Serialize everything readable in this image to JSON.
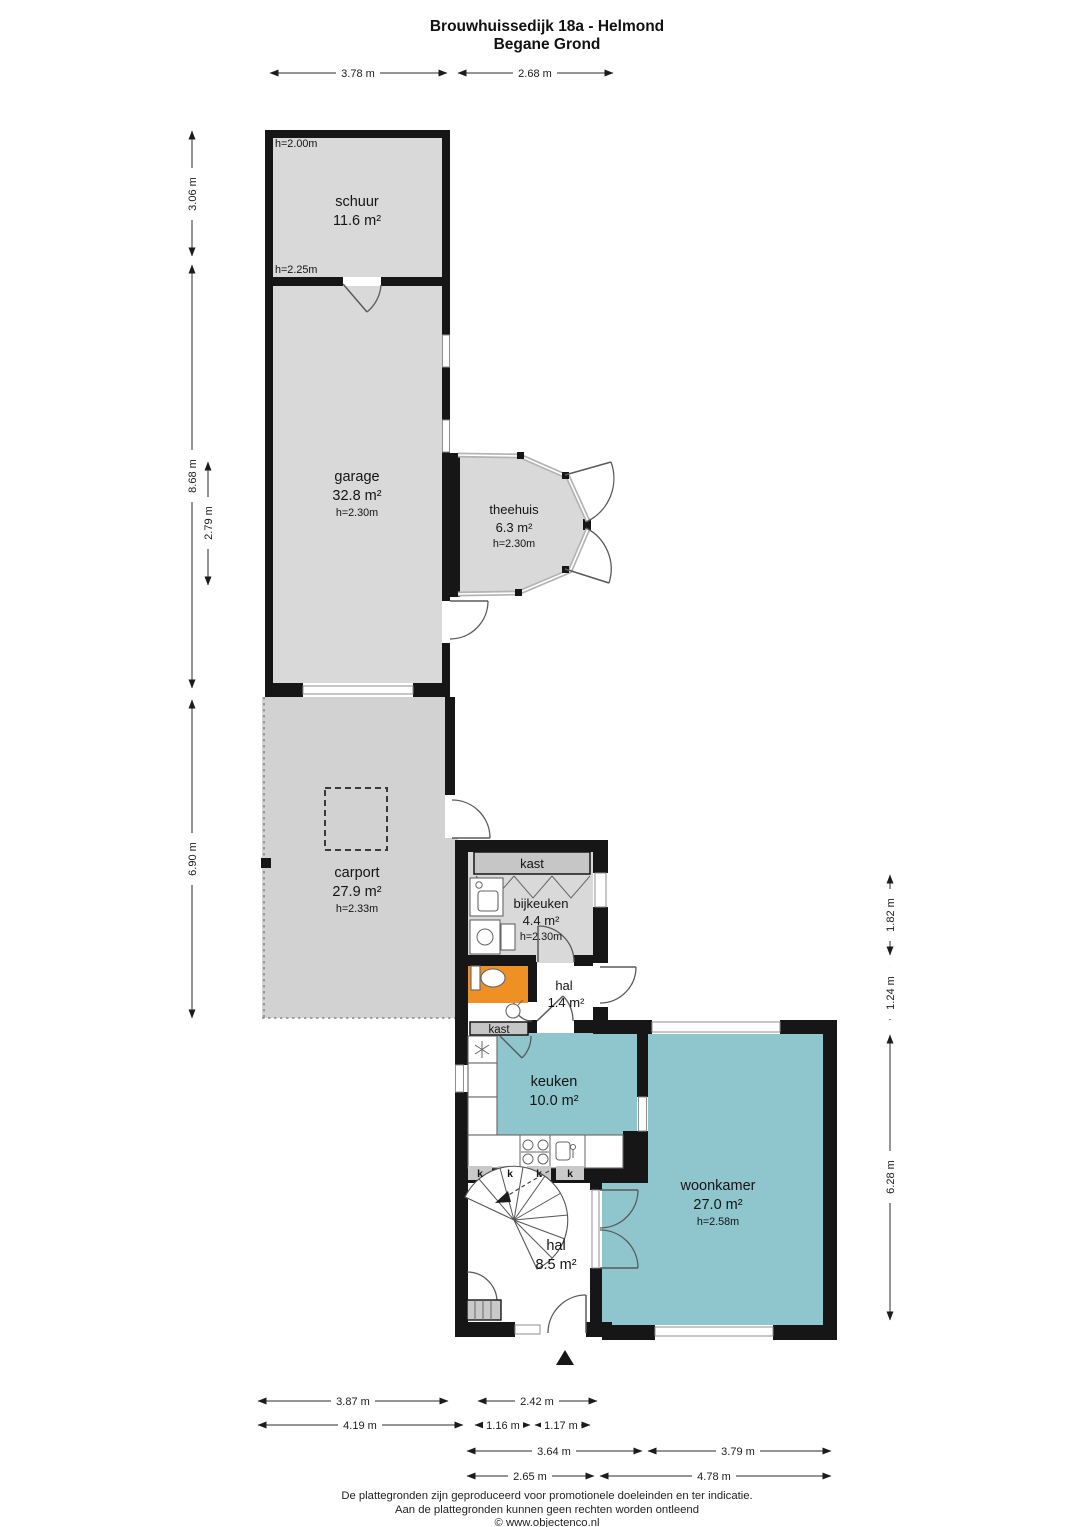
{
  "title": {
    "line1": "Brouwhuissedijk 18a - Helmond",
    "line2": "Begane Grond"
  },
  "rooms": {
    "schuur": {
      "name": "schuur",
      "area": "11.6 m²",
      "height_top": "h=2.00m",
      "height_bottom": "h=2.25m"
    },
    "garage": {
      "name": "garage",
      "area": "32.8 m²",
      "height": "h=2.30m"
    },
    "theehuis": {
      "name": "theehuis",
      "area": "6.3 m²",
      "height": "h=2.30m"
    },
    "carport": {
      "name": "carport",
      "area": "27.9 m²",
      "height": "h=2.33m"
    },
    "bijkeuken": {
      "name": "bijkeuken",
      "area": "4.4 m²",
      "height": "h=2.30m",
      "closet": "kast"
    },
    "hal_klein": {
      "name": "hal",
      "area": "1.4 m²",
      "closet": "kast"
    },
    "keuken": {
      "name": "keuken",
      "area": "10.0 m²",
      "cabinet": "k"
    },
    "woonkamer": {
      "name": "woonkamer",
      "area": "27.0 m²",
      "height": "h=2.58m"
    },
    "hal_groot": {
      "name": "hal",
      "area": "8.5 m²"
    }
  },
  "dimensions": {
    "top": {
      "d1": "3.78 m",
      "d2": "2.68 m"
    },
    "left": {
      "d1": "3.06 m",
      "d2": "8.68 m",
      "d3": "2.79 m",
      "d4": "6.90 m"
    },
    "right": {
      "d1": "1.82 m",
      "d2": "1.24 m",
      "d3": "6.28 m"
    },
    "bottom": {
      "d1": "3.87 m",
      "d2": "2.42 m",
      "d3": "4.19 m",
      "d4": "1.16 m",
      "d5": "1.17 m",
      "d6": "3.64 m",
      "d7": "3.79 m",
      "d8": "2.65 m",
      "d9": "4.78 m"
    }
  },
  "footer": {
    "line1": "De plattegronden zijn geproduceerd voor promotionele doeleinden en ter indicatie.",
    "line2": "Aan de plattegronden kunnen geen rechten worden ontleend",
    "line3": "© www.objectenco.nl"
  },
  "colors": {
    "wall": "#161616",
    "room_fill": "#d9d9d9",
    "carport_fill": "#d2d2d2",
    "teal": "#8fc5cd",
    "orange": "#ef9025",
    "closet_fill": "#c6c6c6"
  }
}
